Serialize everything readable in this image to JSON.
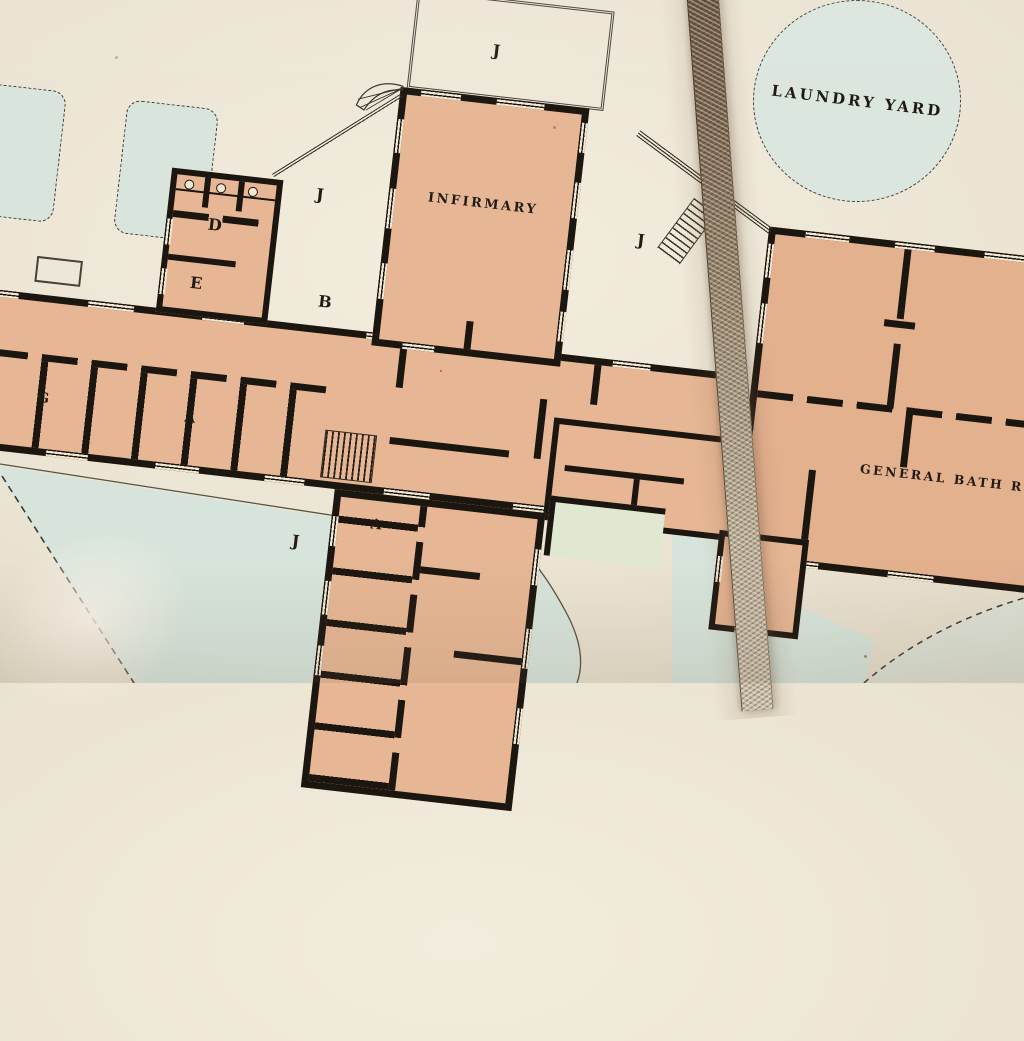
{
  "labels": {
    "infirmary": "INFIRMARY",
    "laundry_yard": "LAUNDRY YARD",
    "general_bath_room": "GENERAL BATH R",
    "court_top": "J",
    "court_left": "J",
    "court_right": "J",
    "court_bottom": "J",
    "room_d": "D",
    "room_e": "E",
    "room_b": "B",
    "room_g": "G",
    "ward_a_main": "A",
    "ward_a_south": "A"
  },
  "colors": {
    "paper": "#ece6d7",
    "building_fill": "#e7b795",
    "building_fill_right": "#e4b18f",
    "wall_ink": "#1c1610",
    "yard_green": "#d7e4db",
    "inset_green": "#e0e8d2",
    "ribbon_brown": "#77614a",
    "text_ink": "#211b14"
  }
}
